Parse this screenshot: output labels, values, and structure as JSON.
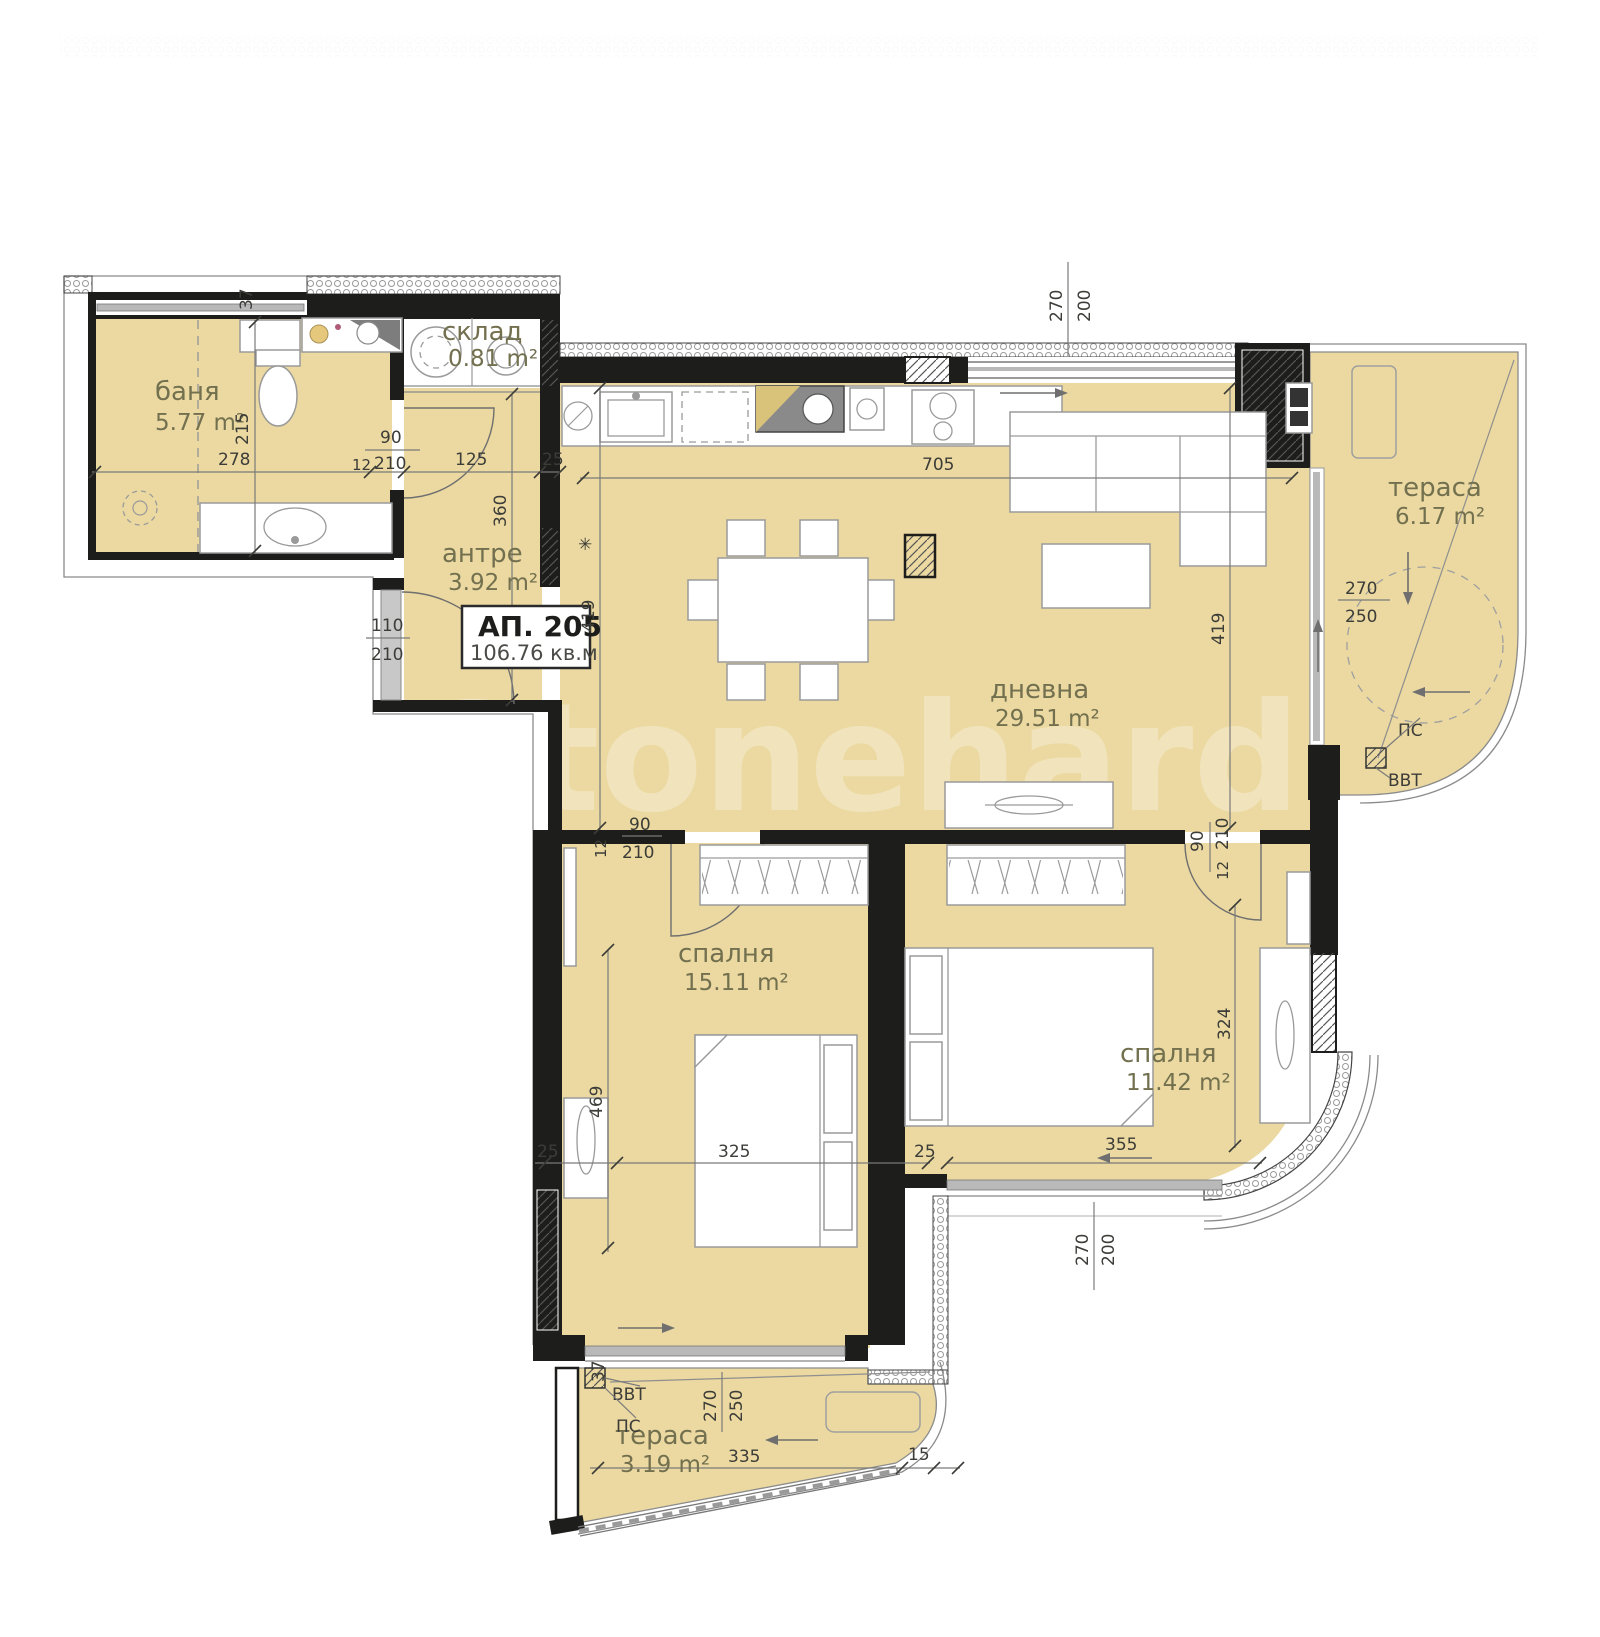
{
  "watermark": "Stonehard",
  "apartment": {
    "label": "АП. 205",
    "area": "106.76 кв.м"
  },
  "rooms": {
    "bath": {
      "name": "баня",
      "area": "5.77 m²"
    },
    "storage": {
      "name": "склад",
      "area": "0.81 m²"
    },
    "hall": {
      "name": "антре",
      "area": "3.92 m²"
    },
    "living": {
      "name": "дневна",
      "area": "29.51 m²"
    },
    "terrace_right": {
      "name": "тераса",
      "area": "6.17 m²"
    },
    "bedroom1": {
      "name": "спалня",
      "area": "15.11 m²"
    },
    "bedroom2": {
      "name": "спалня",
      "area": "11.42 m²"
    },
    "terrace_bottom": {
      "name": "тераса",
      "area": "3.19 m²"
    }
  },
  "annotations": {
    "ps_right": "ПС",
    "vvt_right": "ВВТ",
    "ps_bottom": "ПС",
    "vvt_bottom": "ВВТ",
    "asterisk": "✳"
  },
  "dims": {
    "top37": "37",
    "bath_w": "278",
    "bath_h": "215",
    "bathdoor_w": "90",
    "bathdoor_h": "210",
    "bathdoor_wall": "12",
    "hall_w": "125",
    "wall25a": "25",
    "entry_w": "110",
    "entry_h": "210",
    "hall_h": "360",
    "v419a": "419",
    "v419b": "419",
    "living_w": "705",
    "topwin_w": "270",
    "topwin_h": "200",
    "terr_w": "270",
    "terr_h": "250",
    "b1door_w": "90",
    "b1door_h": "210",
    "b1door_wall": "12",
    "b2door_w": "90",
    "b2door_h": "210",
    "b2door_wall": "12",
    "bed1_v": "469",
    "bed1_w": "325",
    "wall25b": "25",
    "wall25c": "25",
    "bed2_w": "355",
    "bed2_v": "324",
    "b2win_w": "270",
    "b2win_h": "200",
    "bot37": "37",
    "terb_w": "270",
    "terb_h": "250",
    "terb_len": "335",
    "terb_15": "15"
  },
  "colors": {
    "floor": "#ebd9a1",
    "wall": "#1d1d1b",
    "window": "#b9b9b9",
    "door": "#c8c8c8"
  }
}
